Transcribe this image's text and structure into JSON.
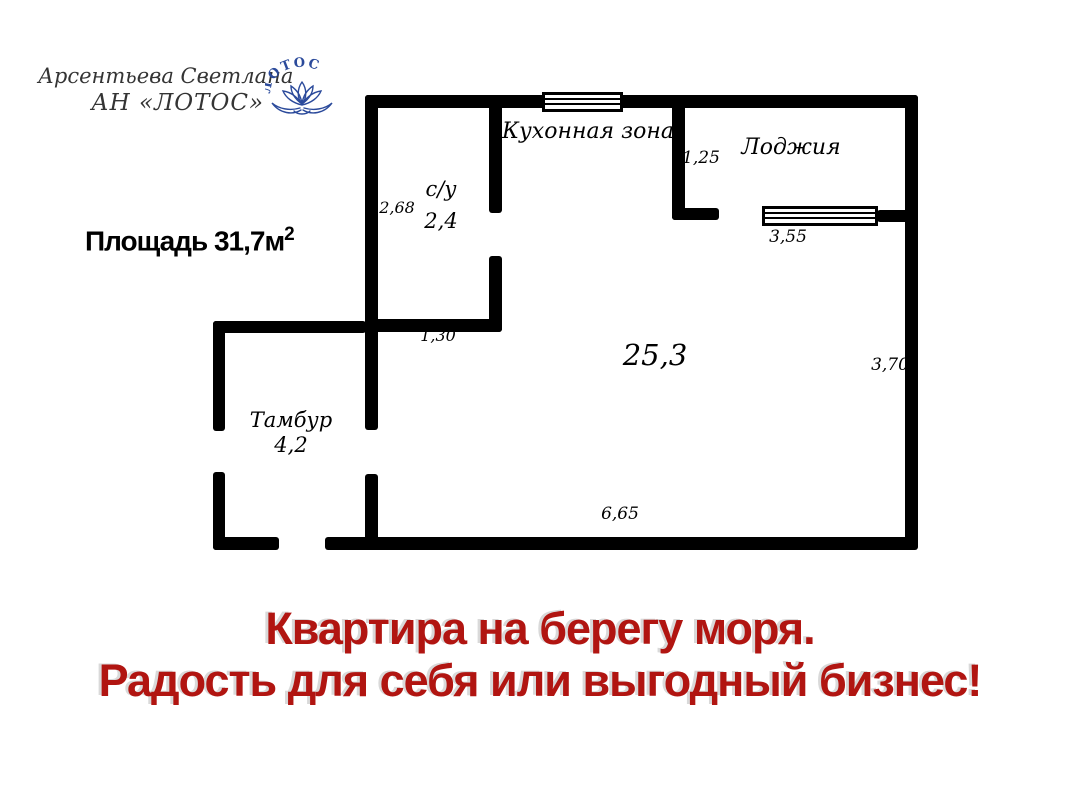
{
  "agency": {
    "agent_name": "Арсентьева Светлана",
    "agency_name": "АН «ЛОТОС»",
    "logo_text": "ЛОТОС",
    "logo_color": "#2b4a9b"
  },
  "area": {
    "label": "Площадь 31,7м",
    "sup": "2"
  },
  "plan": {
    "wall_color": "#000000",
    "kitchen_label": "Кухонная зона",
    "loggia_label": "Лоджия",
    "bathroom_label": "с/у",
    "bathroom_area": "2,4",
    "main_room_area": "25,3",
    "vestibule_label": "Тамбур",
    "vestibule_area": "4,2",
    "dim_bathroom_height": "2,68",
    "dim_loggia_wall": "1,25",
    "dim_loggia_window": "3,55",
    "dim_right_wall": "3,70",
    "dim_bathroom_door": "1,30",
    "dim_bottom_wall": "6,65"
  },
  "tagline": {
    "line1": "Квартира на берегу моря.",
    "line2": "Радость для себя или выгодный бизнес!",
    "color": "#b11511"
  }
}
